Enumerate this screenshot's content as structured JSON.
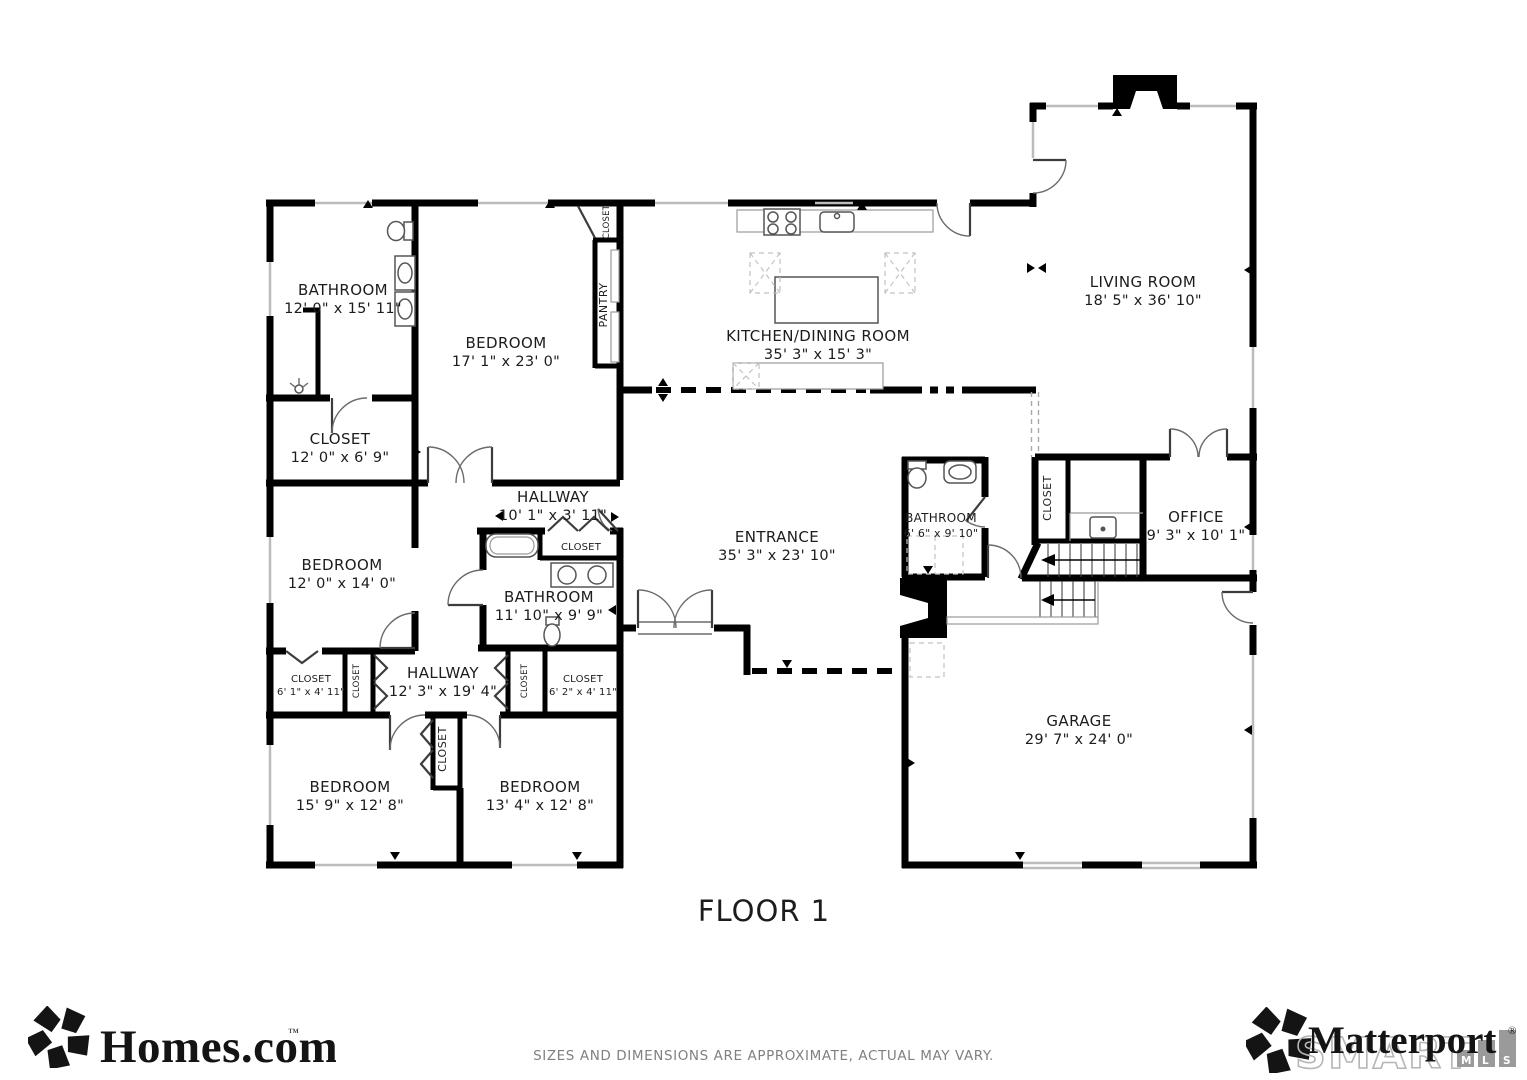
{
  "title": {
    "floor_label": "FLOOR 1"
  },
  "footer": {
    "disclaimer": "SIZES AND DIMENSIONS ARE APPROXIMATE, ACTUAL MAY VARY."
  },
  "branding": {
    "homes_logo_text": "Homes.com",
    "homes_tm": "™",
    "matterport_logo_text": "Matterport",
    "matterport_reg": "®",
    "smart_text": "SMART",
    "mls_boxes": {
      "m": "M",
      "l": "L",
      "s": "S"
    }
  },
  "rooms": [
    {
      "name": "BATHROOM",
      "dims": "12' 0\" x 15' 11\""
    },
    {
      "name": "BEDROOM",
      "dims": "17' 1\" x 23' 0\""
    },
    {
      "name": "PANTRY"
    },
    {
      "name": "CLOSET"
    },
    {
      "name": "KITCHEN/DINING ROOM",
      "dims": "35' 3\" x 15' 3\""
    },
    {
      "name": "LIVING ROOM",
      "dims": "18' 5\" x 36' 10\""
    },
    {
      "name": "CLOSET",
      "dims": "12' 0\" x 6' 9\""
    },
    {
      "name": "HALLWAY",
      "dims": "10' 1\" x 3' 11\""
    },
    {
      "name": "BEDROOM",
      "dims": "12' 0\" x 14' 0\""
    },
    {
      "name": "CLOSET"
    },
    {
      "name": "BATHROOM",
      "dims": "11' 10\" x 9' 9\""
    },
    {
      "name": "ENTRANCE",
      "dims": "35' 3\" x 23' 10\""
    },
    {
      "name": "BATHROOM",
      "dims": "6' 6\" x 9' 10\""
    },
    {
      "name": "CLOSET"
    },
    {
      "name": "OFFICE",
      "dims": "9' 3\" x 10' 1\""
    },
    {
      "name": "HALLWAY",
      "dims": "12' 3\" x 19' 4\""
    },
    {
      "name": "CLOSET",
      "dims": "6' 1\" x 4' 11\""
    },
    {
      "name": "CLOSET"
    },
    {
      "name": "CLOSET"
    },
    {
      "name": "CLOSET",
      "dims": "6' 2\" x 4' 11\""
    },
    {
      "name": "CLOSET"
    },
    {
      "name": "BEDROOM",
      "dims": "15' 9\" x 12' 8\""
    },
    {
      "name": "BEDROOM",
      "dims": "13' 4\" x 12' 8\""
    },
    {
      "name": "GARAGE",
      "dims": "29' 7\" x 24' 0\""
    }
  ],
  "colors": {
    "wall": "#000000",
    "window_line": "#bcbcbc",
    "door_arc": "#6b6b6b",
    "label_text": "#1c1c1c",
    "footer_text": "#808080",
    "smart_gray": "#b5b5b5",
    "mls_box": "#9a9a9a",
    "logo_black": "#141414"
  }
}
